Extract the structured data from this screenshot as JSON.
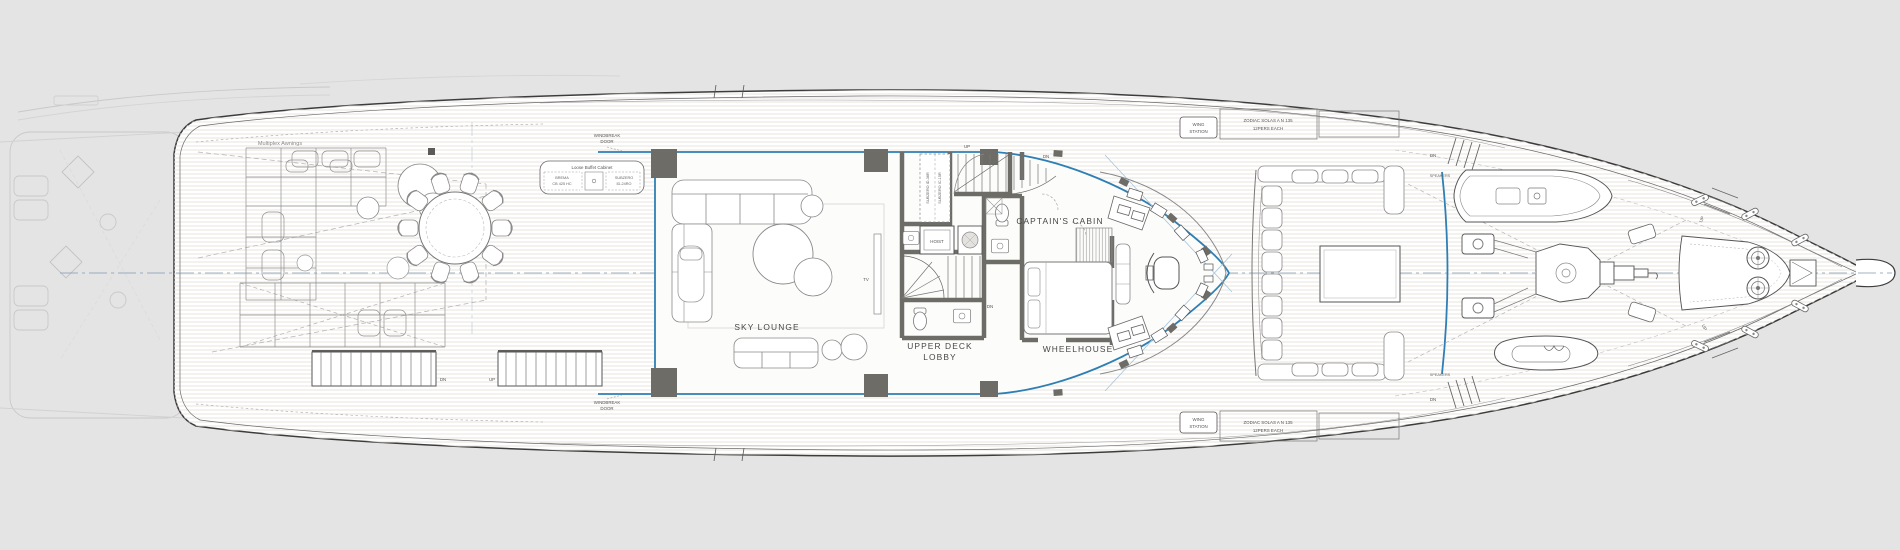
{
  "colors": {
    "background": "#e4e4e4",
    "hull_fill": "#ffffff",
    "glass": "#2f7fb4",
    "wall": "#6e6c67",
    "centerline": "#7f9ab3",
    "outline": "#3c3c3c"
  },
  "labels": {
    "deck_areas": {
      "sky_lounge": "SKY LOUNGE",
      "upper_deck_lobby_line1": "UPPER DECK",
      "upper_deck_lobby_line2": "LOBBY",
      "captains_cabin": "CAPTAIN'S CABIN",
      "wheelhouse": "WHEELHOUSE"
    },
    "equipment": {
      "multiplex_awnings": "Multiplex Awnings",
      "buffet_title": "Loose Buffet Cabinet",
      "buffet_fridge_line1": "BREMA",
      "buffet_fridge_line2": "CB 425 HC",
      "buffet_freezer_line1": "SUBZERO",
      "buffet_freezer_line2": "ID-24RO",
      "pantry_fridge": "SUBZERO ID-36R",
      "pantry_icemaker": "SUBZERO IC-15R",
      "hoist": "HOIST",
      "tv": "TV",
      "speakers": "SPEAKERS",
      "wing_station_line1": "WING",
      "wing_station_line2": "STATION",
      "liferaft_line1": "ZODIAC SOLAS A N 135",
      "liferaft_line2": "12PERS EACH"
    },
    "doors": {
      "windbreak_line1": "WINDBREAK",
      "windbreak_line2": "DOOR"
    },
    "navigation": {
      "up": "UP",
      "dn": "DN"
    }
  }
}
